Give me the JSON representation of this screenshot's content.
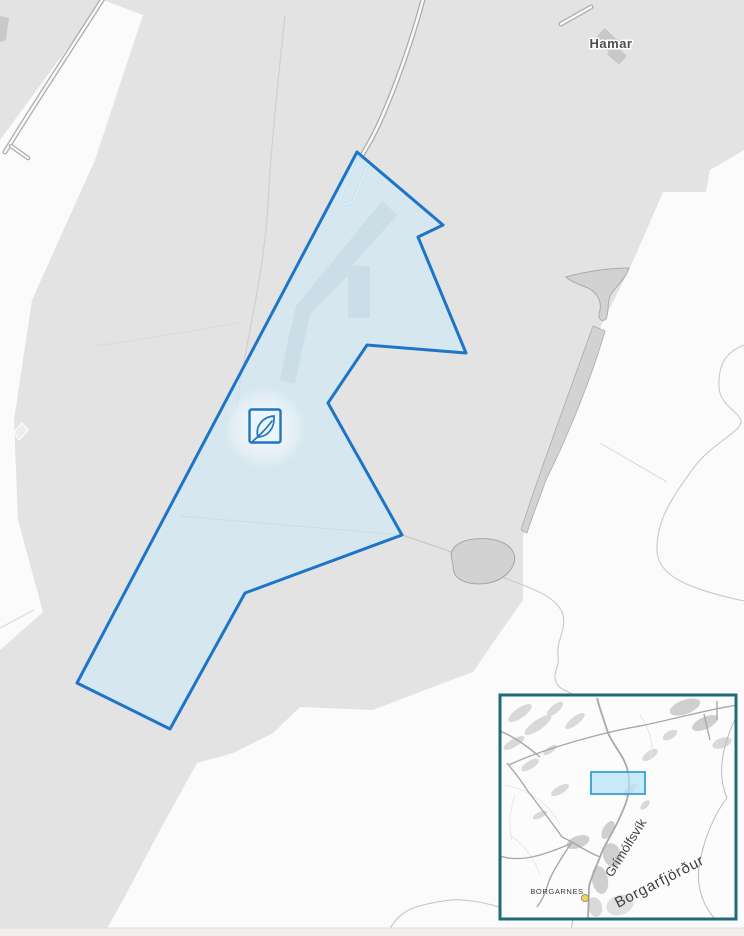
{
  "map": {
    "place_labels": {
      "hamar": "Hamar"
    },
    "marker": {
      "icon": "leaf-in-square",
      "meaning": "protected-area-marker"
    },
    "inset": {
      "labels": {
        "bay": "Grímólfsvík",
        "fjord": "Borgarfjörður",
        "town": "BORGARNES"
      }
    },
    "colors": {
      "base_gray": "#e3e3e3",
      "base_light": "#fbfbfb",
      "polygon_stroke": "#1c75c8",
      "polygon_fill": "#cfeaf7",
      "marker_blue": "#2274bf",
      "inset_border": "#1d6b78",
      "viewport_stroke": "#35a0d9",
      "town_dot_yellow": "#f2d64b",
      "road_casing": "#aeaeae",
      "label_gray": "#4d4d4d"
    }
  }
}
